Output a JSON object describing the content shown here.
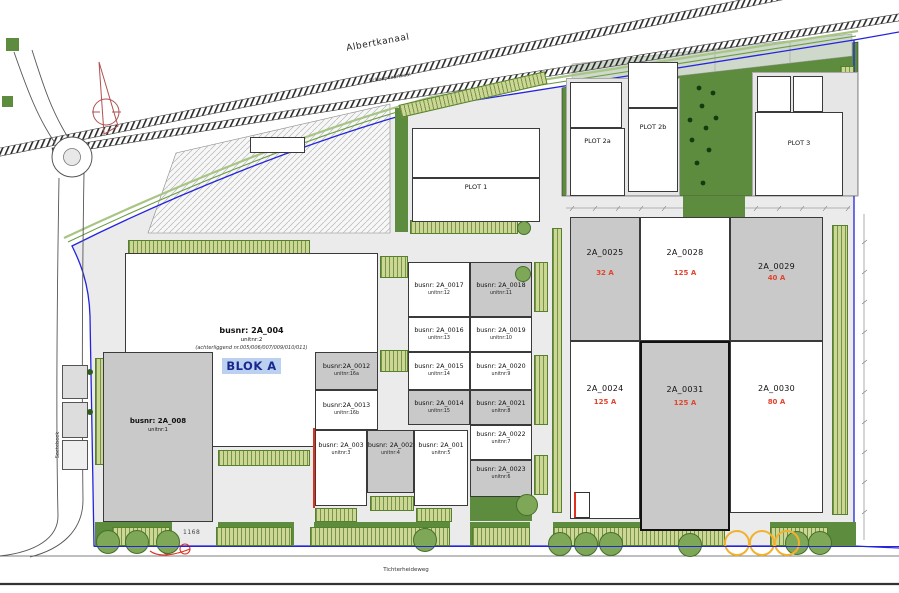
{
  "drawing": {
    "roads": {
      "canal": "Albertkanaal",
      "quay": "Scheepvaartkaai",
      "south_road": "Tichterheideweg",
      "west_road": "Soetebeek"
    },
    "annotations": {
      "dimension": "1168"
    },
    "blok_a": {
      "busnr": "busnr: 2A_004",
      "unitnr": "unitnr:2",
      "note": "(achterliggend nr.005/006/007/009/010/011)",
      "title": "BLOK A"
    },
    "building_008": {
      "busnr": "busnr: 2A_008",
      "unitnr": "unitnr:1"
    },
    "plots": {
      "plot1": "PLOT 1",
      "plot2a": "PLOT 2a",
      "plot2b": "PLOT 2b",
      "plot3": "PLOT 3"
    },
    "units": [
      {
        "busnr": "busnr: 2A_0017",
        "unitnr": "unitnr:12"
      },
      {
        "busnr": "busnr: 2A_0018",
        "unitnr": "unitnr:11"
      },
      {
        "busnr": "busnr: 2A_0016",
        "unitnr": "unitnr:13"
      },
      {
        "busnr": "busnr: 2A_0019",
        "unitnr": "unitnr:10"
      },
      {
        "busnr": "busnr:2A_0012",
        "unitnr": "unitnr:16a"
      },
      {
        "busnr": "busnr:2A_0013",
        "unitnr": "unitnr:16b"
      },
      {
        "busnr": "busnr: 2A_0015",
        "unitnr": "unitnr:14"
      },
      {
        "busnr": "busnr: 2A_0020",
        "unitnr": "unitnr:9"
      },
      {
        "busnr": "busnr: 2A_0014",
        "unitnr": "unitnr:15"
      },
      {
        "busnr": "busnr: 2A_0021",
        "unitnr": "unitnr:8"
      },
      {
        "busnr": "busnr: 2A_0022",
        "unitnr": "unitnr:7"
      },
      {
        "busnr": "busnr: 2A_0023",
        "unitnr": "unitnr:6"
      },
      {
        "busnr": "busnr: 2A_003",
        "unitnr": "unitnr:3"
      },
      {
        "busnr": "busnr: 2A_002",
        "unitnr": "unitnr:4"
      },
      {
        "busnr": "busnr: 2A_001",
        "unitnr": "unitnr:5"
      }
    ],
    "parcels": [
      {
        "id": "2A_0025",
        "amp": "32 A"
      },
      {
        "id": "2A_0028",
        "amp": "125 A"
      },
      {
        "id": "2A_0029",
        "amp": "40 A"
      },
      {
        "id": "2A_0024",
        "amp": "125 A"
      },
      {
        "id": "2A_0031",
        "amp": "125 A"
      },
      {
        "id": "2A_0030",
        "amp": "80 A"
      }
    ],
    "colors": {
      "boundary_blue": "#2424dd",
      "amp_red": "#e0452e",
      "blok_a_blue": "#17288f",
      "blok_a_highlight": "#bcd0f0",
      "landscape_green": "#5d8c3e",
      "planting_cells": "#cdd794",
      "tree_green": "#7fa758",
      "proposed_tree_yellow": "#f2b12f",
      "building_gray": "#c9c9c9",
      "paving_gray": "#ebebeb",
      "north_arrow_red": "#b05050"
    }
  }
}
